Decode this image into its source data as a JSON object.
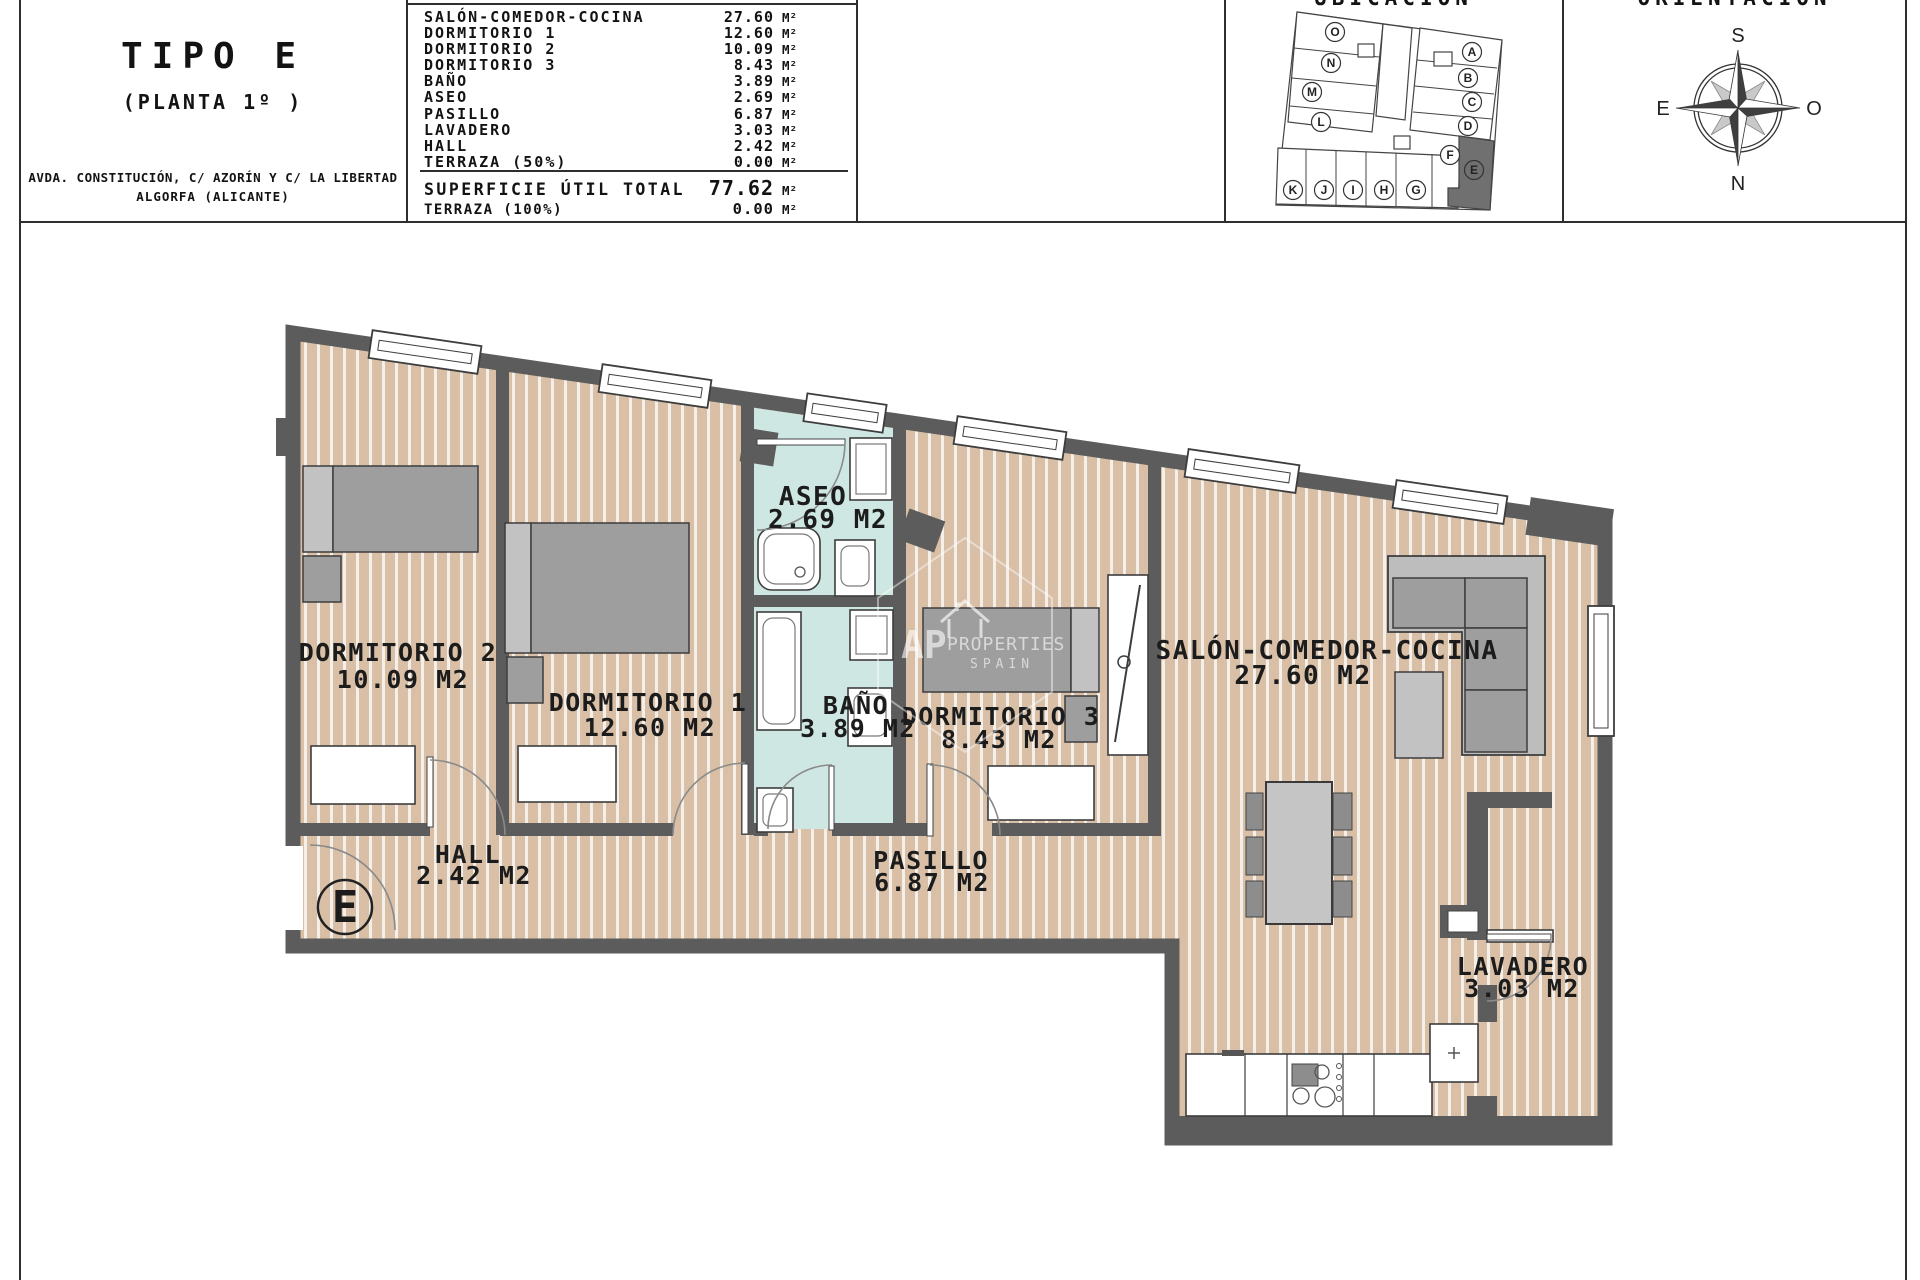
{
  "header": {
    "title": "TIPO E",
    "subtitle": "(PLANTA 1º )",
    "address_line1": "AVDA. CONSTITUCIÓN, C/ AZORÍN Y C/ LA LIBERTAD",
    "address_line2": "ALGORFA (ALICANTE)",
    "areas": {
      "rows": [
        {
          "label": "SALÓN-COMEDOR-COCINA",
          "value": "27.60",
          "unit": "M²"
        },
        {
          "label": "DORMITORIO 1",
          "value": "12.60",
          "unit": "M²"
        },
        {
          "label": "DORMITORIO 2",
          "value": "10.09",
          "unit": "M²"
        },
        {
          "label": "DORMITORIO 3",
          "value": "8.43",
          "unit": "M²"
        },
        {
          "label": "BAÑO",
          "value": "3.89",
          "unit": "M²"
        },
        {
          "label": "ASEO",
          "value": "2.69",
          "unit": "M²"
        },
        {
          "label": "PASILLO",
          "value": "6.87",
          "unit": "M²"
        },
        {
          "label": "LAVADERO",
          "value": "3.03",
          "unit": "M²"
        },
        {
          "label": "HALL",
          "value": "2.42",
          "unit": "M²"
        },
        {
          "label": "TERRAZA (50%)",
          "value": "0.00",
          "unit": "M²"
        }
      ],
      "total_label": "SUPERFICIE ÚTIL TOTAL",
      "total_value": "77.62",
      "total_unit": "M²",
      "terraza_label": "TERRAZA (100%)",
      "terraza_value": "0.00",
      "terraza_unit": "M²"
    },
    "ubicacion_title": "UBICACIÓN",
    "orientacion_title": "ORIENTACIÓN"
  },
  "site_plan": {
    "units": [
      "O",
      "N",
      "M",
      "L",
      "A",
      "B",
      "C",
      "D",
      "F",
      "E",
      "K",
      "J",
      "I",
      "H",
      "G"
    ],
    "highlighted_unit": "E"
  },
  "compass": {
    "top": "S",
    "bottom": "N",
    "left": "E",
    "right": "O"
  },
  "plan": {
    "rooms": [
      {
        "name": "DORMITORIO 2",
        "area": "10.09 M2"
      },
      {
        "name": "DORMITORIO 1",
        "area": "12.60 M2"
      },
      {
        "name": "ASEO",
        "area": "2.69 M2"
      },
      {
        "name": "BAÑO",
        "area": "3.89 M2"
      },
      {
        "name": "DORMITORIO 3",
        "area": "8.43 M2"
      },
      {
        "name": "SALÓN-COMEDOR-COCINA",
        "area": "27.60 M2"
      },
      {
        "name": "HALL",
        "area": "2.42 M2"
      },
      {
        "name": "PASILLO",
        "area": "6.87 M2"
      },
      {
        "name": "LAVADERO",
        "area": "3.03 M2"
      }
    ],
    "entrance_label": "E"
  },
  "watermark": {
    "line1": "AP",
    "line2": "PROPERTIES",
    "line3": "SPAIN"
  },
  "colors": {
    "wall": "#5c5c5c",
    "wood": "#d8bfa6",
    "stripe": "#ffffff",
    "tile": "#cfe7e2",
    "furniture": "#9e9e9e",
    "accent_dark_unit": "#707070"
  }
}
